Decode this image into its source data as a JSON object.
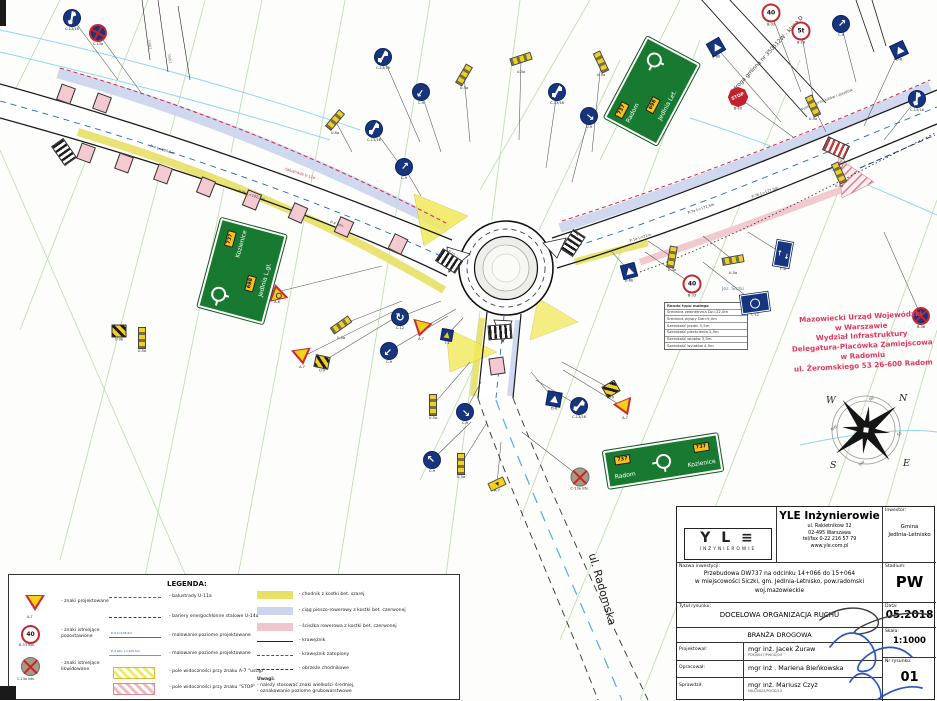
{
  "stamp": [
    "Mazowiecki Urząd Wojewódzki",
    "w Warszawie",
    "Wydział Infrastruktury",
    "Delegatura-Placówka Zamiejscowa",
    "w Radomiu",
    "ul. Żeromskiego 53 26-600 Radom"
  ],
  "compass": {
    "n": "N",
    "e": "E",
    "s": "S",
    "w": "W",
    "nw": "NW",
    "ne": "NE",
    "se": "SE",
    "sw": "SW"
  },
  "guide_signs": {
    "top": {
      "route1": "737",
      "dest1": "Radom",
      "route2": "698",
      "dest2": "Jedlnia Let."
    },
    "left": {
      "route1": "737",
      "dest1": "Kozienice",
      "route2": "698",
      "dest2": "Jedlnia L.gł."
    },
    "bottom": {
      "route_l": "737",
      "dest_l": "Radom",
      "route_r": "737",
      "dest_r": "Kozienice"
    }
  },
  "param_table": {
    "rows": [
      "Rondo typu małego",
      "Średnica zewnętrzna Dz=22,0m",
      "Średnica wyspy Dw=9,0m",
      "Szerokość jezdni 5,5m",
      "Szerokość pierścienia 1,5m",
      "Szerokość wlotów 3,5m",
      "Szerokość wylotów 4,5m"
    ]
  },
  "legend": {
    "title": "LEGENDA:",
    "col1": [
      {
        "sub": "A-7",
        "label": "- znaki projektowane"
      },
      {
        "sub": "B-33 istn.",
        "label": "- znaki istniejące\npozostawione"
      },
      {
        "sub": "C-13a istn.",
        "label": "- znaki istniejące\nlikwidowane"
      }
    ],
    "col2": [
      {
        "label": "- balustrady U-11a"
      },
      {
        "label": "- bariery energochłonne stalowe U-14a"
      },
      {
        "label": "- malowanie poziome projektowane",
        "sample": "P-4  L=105,5m"
      },
      {
        "label": "- malowanie poziome projektowane",
        "sample": "P-4 istn.  L=105,5m"
      },
      {
        "label": "- pole widoczności przy znaku A-7 \"ustąp\""
      },
      {
        "label": "- pole widoczności przy znaku \"STOP\""
      }
    ],
    "col3": [
      {
        "label": "- chodnik z kostki bet. szarej"
      },
      {
        "label": "- ciąg pieszo-rowerowy z kostki bet. czerwonej"
      },
      {
        "label": "- ścieżka rowerowa z kostki bet. czerwonej"
      },
      {
        "label": "- krawężnik"
      },
      {
        "label": "- krawężnik zatopiony"
      },
      {
        "label": "- obrzeże chodnikowe"
      }
    ],
    "notes": {
      "title": "Uwagi:",
      "line1": "- należy stosować znaki wielkości średniej,",
      "line2": "- oznakowanie poziome grubowarstwowe"
    },
    "legend_40": "40"
  },
  "titleblock": {
    "company": {
      "name": "YLE Inżynierowie",
      "addr1": "ul. Rakietników 32",
      "addr2": "02-495 Warszawa",
      "addr3": "tel/fax 0-22 216 57 79",
      "addr4": "www.yle.com.pl",
      "logo_glyph": "Y L ≡",
      "logo_sub": "INŻYNIEROWIE"
    },
    "investor_label": "Inwestor:",
    "investor1": "Gmina",
    "investor2": "Jedlnia-Letnisko",
    "project_label": "Nazwa inwestycji:",
    "project1": "Przebudowa DW737 na odcinku 14+066 do 15+064",
    "project2": "w miejscowości Siczki, gm. Jedlnia-Letnisko, pow.radomski",
    "project3": "woj.mazowieckie",
    "stadium_label": "Stadium:",
    "stadium": "PW",
    "title_label": "Tytuł rysunku:",
    "title": "DOCELOWA ORGANIZACJA RUCHU",
    "date_label": "Data:",
    "date": "05.2018",
    "branch": "BRANŻA DROGOWA",
    "scale_label": "Skala:",
    "scale": "1:1000",
    "designed_label": "Projektował:",
    "designed": "mgr inż. Jacek Żuraw",
    "designed_no": "PDK/6047/PWOD/04",
    "drafted_label": "Opracował:",
    "drafted": "mgr inż . Marlena Bieńkowska",
    "checked_label": "Sprawdził:",
    "checked": "mgr inż. Mariusz Czyż",
    "checked_no": "MAZ/0023/POOD/14",
    "number_label": "Nr rysunku:",
    "number": "01"
  },
  "map": {
    "signs": [
      {
        "t": "c1316",
        "x": 72,
        "y": 18,
        "r": -20,
        "tag": "C-13/16",
        "lx": 118,
        "ly": 80
      },
      {
        "t": "bluex",
        "x": 98,
        "y": 33,
        "r": -15,
        "tag": "C-13a",
        "lx": 142,
        "ly": 94
      },
      {
        "t": "pylon",
        "x": 335,
        "y": 120,
        "r": 40,
        "tag": "U-5a",
        "lx": 352,
        "ly": 152
      },
      {
        "t": "c1316",
        "x": 374,
        "y": 129,
        "r": 0,
        "tag": "C-13/16",
        "lx": 398,
        "ly": 162
      },
      {
        "t": "c9",
        "x": 404,
        "y": 167,
        "r": 40,
        "tag": "C-9",
        "lx": 421,
        "ly": 196
      },
      {
        "t": "c1316",
        "x": 383,
        "y": 57,
        "r": 0,
        "tag": "C-13/16",
        "lx": 420,
        "ly": 142
      },
      {
        "t": "c9",
        "x": 421,
        "y": 92,
        "r": 215,
        "tag": "C-9",
        "lx": 441,
        "ly": 152
      },
      {
        "t": "pylon",
        "x": 464,
        "y": 75,
        "r": 30,
        "tag": "U-5a",
        "lx": 470,
        "ly": 142
      },
      {
        "t": "pylon",
        "x": 521,
        "y": 59,
        "r": 72,
        "tag": "U-5a",
        "lx": 519,
        "ly": 140
      },
      {
        "t": "c1316",
        "x": 557,
        "y": 92,
        "r": 0,
        "tag": "C-13/16",
        "lx": 546,
        "ly": 168
      },
      {
        "t": "c9",
        "x": 589,
        "y": 116,
        "r": 130,
        "tag": "C-9",
        "lx": 572,
        "ly": 182
      },
      {
        "t": "pylon",
        "x": 601,
        "y": 62,
        "r": -25,
        "tag": "U-5a",
        "lx": 592,
        "ly": 152
      },
      {
        "t": "d6",
        "x": 716,
        "y": 47,
        "r": -30,
        "tag": "D-6b",
        "lx": 781,
        "ly": 122
      },
      {
        "t": "stop",
        "x": 738,
        "y": 97,
        "r": -24,
        "tag": "B-20",
        "txt": "STOP",
        "lx": 793,
        "ly": 137
      },
      {
        "t": "b33",
        "x": 771,
        "y": 13,
        "r": 0,
        "tag": "B-33",
        "txt": "40",
        "lx": 801,
        "ly": 92
      },
      {
        "t": "b33",
        "x": 801,
        "y": 31,
        "r": 0,
        "tag": "B-18",
        "txt": "5t",
        "lx": 813,
        "ly": 97
      },
      {
        "t": "c9",
        "x": 841,
        "y": 24,
        "r": 45,
        "tag": "C-9",
        "lx": 856,
        "ly": 82
      },
      {
        "t": "d6",
        "x": 899,
        "y": 50,
        "r": -25,
        "tag": "D-6",
        "lx": 864,
        "ly": 126
      },
      {
        "t": "c1316",
        "x": 917,
        "y": 99,
        "r": -25,
        "tag": "C-13/16",
        "lx": 884,
        "ly": 140
      },
      {
        "t": "pylon",
        "x": 813,
        "y": 106,
        "r": -25,
        "tag": "U-5a",
        "lx": 826,
        "ly": 132
      },
      {
        "t": "pylon",
        "x": 839,
        "y": 173,
        "r": -25,
        "tag": "U-5a",
        "lx": 845,
        "ly": 160
      },
      {
        "t": "bluex",
        "x": 921,
        "y": 316,
        "r": 0,
        "tag": "B-36",
        "lx": 884,
        "ly": 232
      },
      {
        "t": "a8",
        "x": 277,
        "y": 292,
        "r": -12,
        "tag": "A-8",
        "lx": 382,
        "ly": 266
      },
      {
        "t": "pylon",
        "x": 341,
        "y": 325,
        "r": 55,
        "tag": "U-5a",
        "lx": 402,
        "ly": 301
      },
      {
        "t": "a7",
        "x": 302,
        "y": 357,
        "r": -8,
        "tag": "A-7",
        "lx": 392,
        "ly": 312
      },
      {
        "t": "stripe",
        "x": 322,
        "y": 362,
        "r": 12,
        "tag": "U-9",
        "lx": 398,
        "ly": 316
      },
      {
        "t": "c12",
        "x": 400,
        "y": 317,
        "r": 0,
        "tag": "C-12",
        "lx": 441,
        "ly": 301
      },
      {
        "t": "c9",
        "x": 389,
        "y": 351,
        "r": 225,
        "tag": "C-9",
        "lx": 448,
        "ly": 316
      },
      {
        "t": "a7",
        "x": 421,
        "y": 329,
        "r": 14,
        "tag": "A-7",
        "lx": 456,
        "ly": 309
      },
      {
        "t": "d6s",
        "x": 447,
        "y": 335,
        "r": 10,
        "tag": "T-1",
        "lx": 463,
        "ly": 318
      },
      {
        "t": "pylon",
        "x": 433,
        "y": 405,
        "r": 0,
        "tag": "U-5a",
        "lx": 470,
        "ly": 362
      },
      {
        "t": "c9",
        "x": 465,
        "y": 412,
        "r": 135,
        "tag": "C-9",
        "lx": 481,
        "ly": 382
      },
      {
        "t": "c9",
        "x": 432,
        "y": 460,
        "r": -45,
        "tag": "C-9",
        "lx": 471,
        "ly": 422
      },
      {
        "t": "pylon",
        "x": 461,
        "y": 464,
        "r": 0,
        "tag": "U-5a",
        "lx": 486,
        "ly": 424
      },
      {
        "t": "platea7",
        "x": 497,
        "y": 484,
        "r": -25,
        "tag": "A-7",
        "lx": 501,
        "ly": 442
      },
      {
        "t": "removed",
        "x": 580,
        "y": 477,
        "r": 0,
        "tag": "C-13a istn.",
        "lx": 522,
        "ly": 432
      },
      {
        "t": "d6",
        "x": 554,
        "y": 399,
        "r": 10,
        "tag": "D-6",
        "lx": 531,
        "ly": 372
      },
      {
        "t": "c1316",
        "x": 579,
        "y": 406,
        "r": 10,
        "tag": "C-13/16",
        "lx": 536,
        "ly": 380
      },
      {
        "t": "stripe",
        "x": 611,
        "y": 389,
        "r": -30,
        "tag": "U-9",
        "lx": 562,
        "ly": 362
      },
      {
        "t": "a7",
        "x": 625,
        "y": 408,
        "r": -22,
        "tag": "A-7",
        "lx": 563,
        "ly": 370
      },
      {
        "t": "b33",
        "x": 692,
        "y": 284,
        "r": 0,
        "tag": "B-33",
        "txt": "40",
        "lx": 645,
        "ly": 252
      },
      {
        "t": "pylon",
        "x": 672,
        "y": 257,
        "r": 10,
        "tag": "U-3e",
        "lx": 648,
        "ly": 241
      },
      {
        "t": "pylon",
        "x": 733,
        "y": 260,
        "r": 80,
        "tag": "U-5a",
        "lx": 703,
        "ly": 236
      },
      {
        "t": "d6",
        "x": 629,
        "y": 271,
        "r": -15,
        "tag": "D-6b",
        "lx": 612,
        "ly": 252
      },
      {
        "t": "bluerect",
        "x": 755,
        "y": 303,
        "r": -8,
        "tag": "C-12",
        "lx": 703,
        "ly": 262
      },
      {
        "t": "bluerect2",
        "x": 783,
        "y": 254,
        "r": 10,
        "tag": "F-6",
        "lx": 748,
        "ly": 232
      },
      {
        "t": "stripe",
        "x": 119,
        "y": 331,
        "r": 0,
        "tag": "U-9b"
      },
      {
        "t": "pylon",
        "x": 142,
        "y": 338,
        "r": 0,
        "tag": "U-5a"
      }
    ],
    "crossings": [
      {
        "x": 449,
        "y": 261,
        "r": 33
      },
      {
        "x": 573,
        "y": 243,
        "r": -57
      },
      {
        "x": 500,
        "y": 332,
        "r": -4
      },
      {
        "x": 836,
        "y": 148,
        "r": 25,
        "red": true
      },
      {
        "x": 64,
        "y": 152,
        "r": 55
      }
    ],
    "driveways": [
      {
        "x": 86,
        "y": 153,
        "r": 20
      },
      {
        "x": 124,
        "y": 163,
        "r": 20
      },
      {
        "x": 163,
        "y": 174,
        "r": 20
      },
      {
        "x": 206,
        "y": 187,
        "r": 22
      },
      {
        "x": 252,
        "y": 200,
        "r": 22
      },
      {
        "x": 298,
        "y": 213,
        "r": 24
      },
      {
        "x": 344,
        "y": 227,
        "r": 24
      },
      {
        "x": 398,
        "y": 244,
        "r": 26
      },
      {
        "x": 66,
        "y": 94,
        "r": 20
      },
      {
        "x": 102,
        "y": 103,
        "r": 20
      },
      {
        "x": 497,
        "y": 366,
        "r": -8
      }
    ],
    "labels": [
      {
        "t": "ul. Radomska",
        "x": 592,
        "y": 548,
        "r": 74,
        "s": 11,
        "c": "#1a1a1a"
      },
      {
        "t": "droga gminna nr 350512W - klasa D",
        "x": 735,
        "y": 88,
        "r": -47,
        "s": 5.5,
        "c": "#333"
      },
      {
        "t": "wyokrąglenie łuków i zjazdów",
        "x": 800,
        "y": 108,
        "r": -21,
        "s": 3.8,
        "c": "#555"
      },
      {
        "t": "Jez. Siczki",
        "x": 722,
        "y": 288,
        "r": 0,
        "s": 4.5,
        "c": "#4a86c8"
      },
      {
        "t": "P-4  L=105,5m",
        "x": 150,
        "y": 145,
        "r": 17,
        "s": 3.6,
        "c": "#333"
      },
      {
        "t": "P-7b  L=102,5m",
        "x": 238,
        "y": 190,
        "r": 18,
        "s": 3.6,
        "c": "#333"
      },
      {
        "t": "P-4 istn.",
        "x": 330,
        "y": 221,
        "r": 18,
        "s": 3.6,
        "c": "#333"
      },
      {
        "t": "balustrada U-11a",
        "x": 285,
        "y": 168,
        "r": 17,
        "s": 3.6,
        "c": "#b03050"
      },
      {
        "t": "P-7a  L=172,5m",
        "x": 688,
        "y": 212,
        "r": -18,
        "s": 3.6,
        "c": "#333"
      },
      {
        "t": "P-7b  L=177,5m",
        "x": 752,
        "y": 196,
        "r": -19,
        "s": 3.6,
        "c": "#333"
      },
      {
        "t": "P-1e  L=21m",
        "x": 630,
        "y": 240,
        "r": -17,
        "s": 3.6,
        "c": "#333"
      },
      {
        "t": "349/2",
        "x": 148,
        "y": 38,
        "r": 80,
        "s": 3.5,
        "c": "#777"
      },
      {
        "t": "350/1",
        "x": 168,
        "y": 52,
        "r": 80,
        "s": 3.5,
        "c": "#777"
      },
      {
        "t": "P-10",
        "x": 448,
        "y": 250,
        "r": 33,
        "s": 3.3,
        "c": "#333"
      },
      {
        "t": "P-10",
        "x": 574,
        "y": 236,
        "r": -30,
        "s": 3.3,
        "c": "#333"
      }
    ]
  }
}
